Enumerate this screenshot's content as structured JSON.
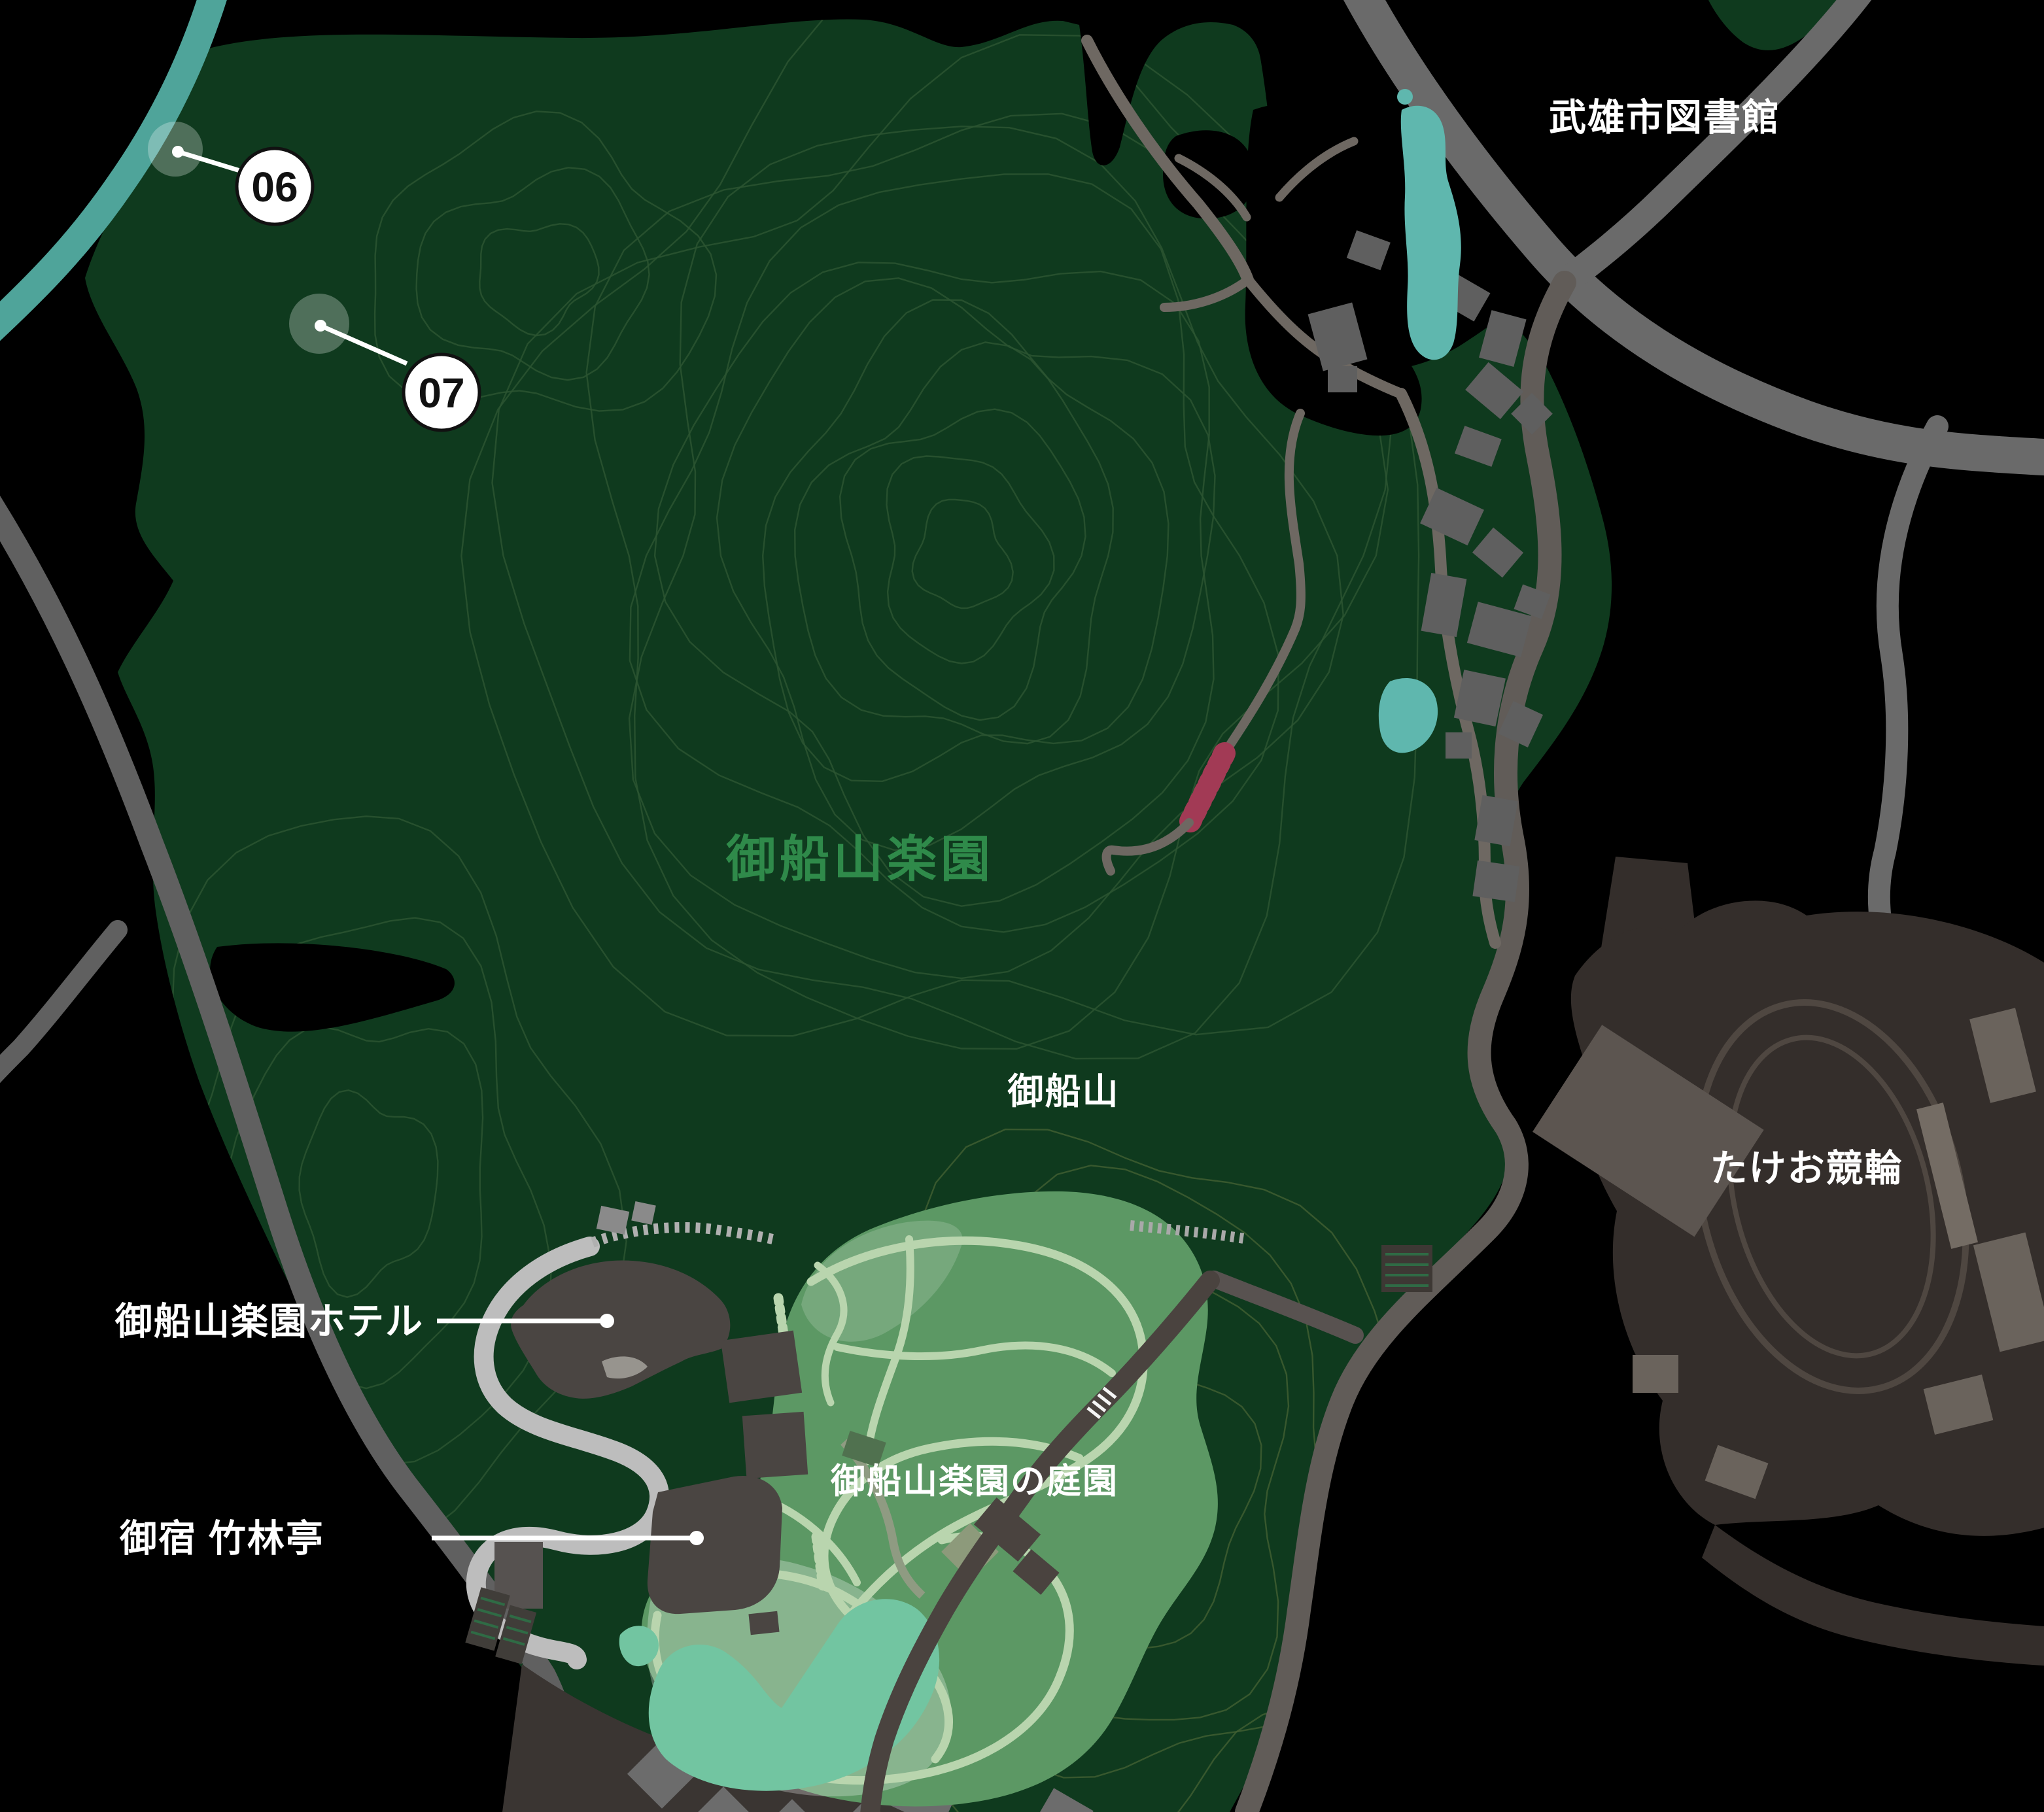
{
  "map": {
    "title": "Mifuneyama Rakuen area map",
    "region_labels": {
      "library": "武雄市図書館",
      "park": "御船山楽園",
      "mountain": "御船山",
      "keirin": "たけお競輪",
      "garden": "御船山楽園の庭園"
    },
    "poi_labels": {
      "hotel": "御船山楽園ホテル",
      "ryokan": "御宿 竹林亭"
    },
    "markers": [
      {
        "id": "06",
        "label": "06"
      },
      {
        "id": "07",
        "label": "07"
      }
    ],
    "colors": {
      "background": "#000000",
      "forest": "#0f3a1e",
      "contour": "#2b5531",
      "garden": "#5c9864",
      "garden_pond": "#72c5a1",
      "water": "#4fa49a",
      "road": "#6a6a6a",
      "road_dark": "#4a433f",
      "road_light": "#bdbdbd",
      "building": "#5f5f5f",
      "velodrome_area": "#342e2b",
      "stairs": "#a23a55",
      "label_white": "#ffffff",
      "label_green": "#2f8a4a",
      "marker_fill": "#ffffff",
      "marker_text": "#111111"
    }
  }
}
